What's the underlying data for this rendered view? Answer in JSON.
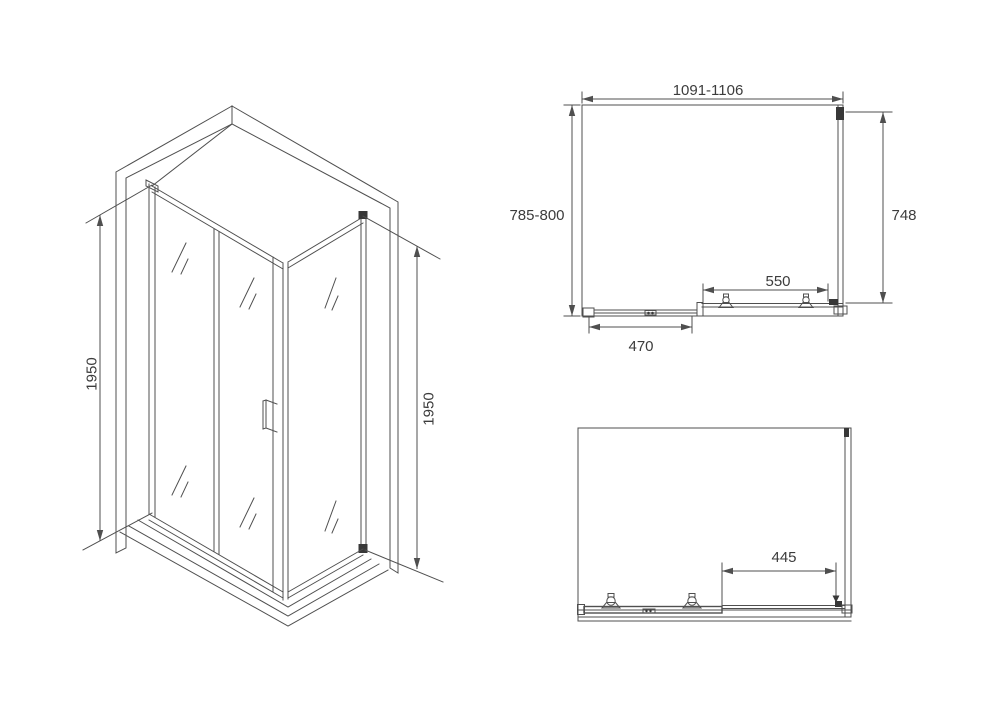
{
  "background": "#ffffff",
  "stroke_color": "#4f4f4f",
  "text_color": "#3c3c3c",
  "views": {
    "isometric": {
      "height_left": "1950",
      "height_right": "1950"
    },
    "plan": {
      "width_range": "1091-1106",
      "depth_range": "785-800",
      "side_depth": "748",
      "sliding_door_width": "550",
      "fixed_panel_width": "470"
    },
    "elevation": {
      "door_opening_width": "445"
    }
  }
}
